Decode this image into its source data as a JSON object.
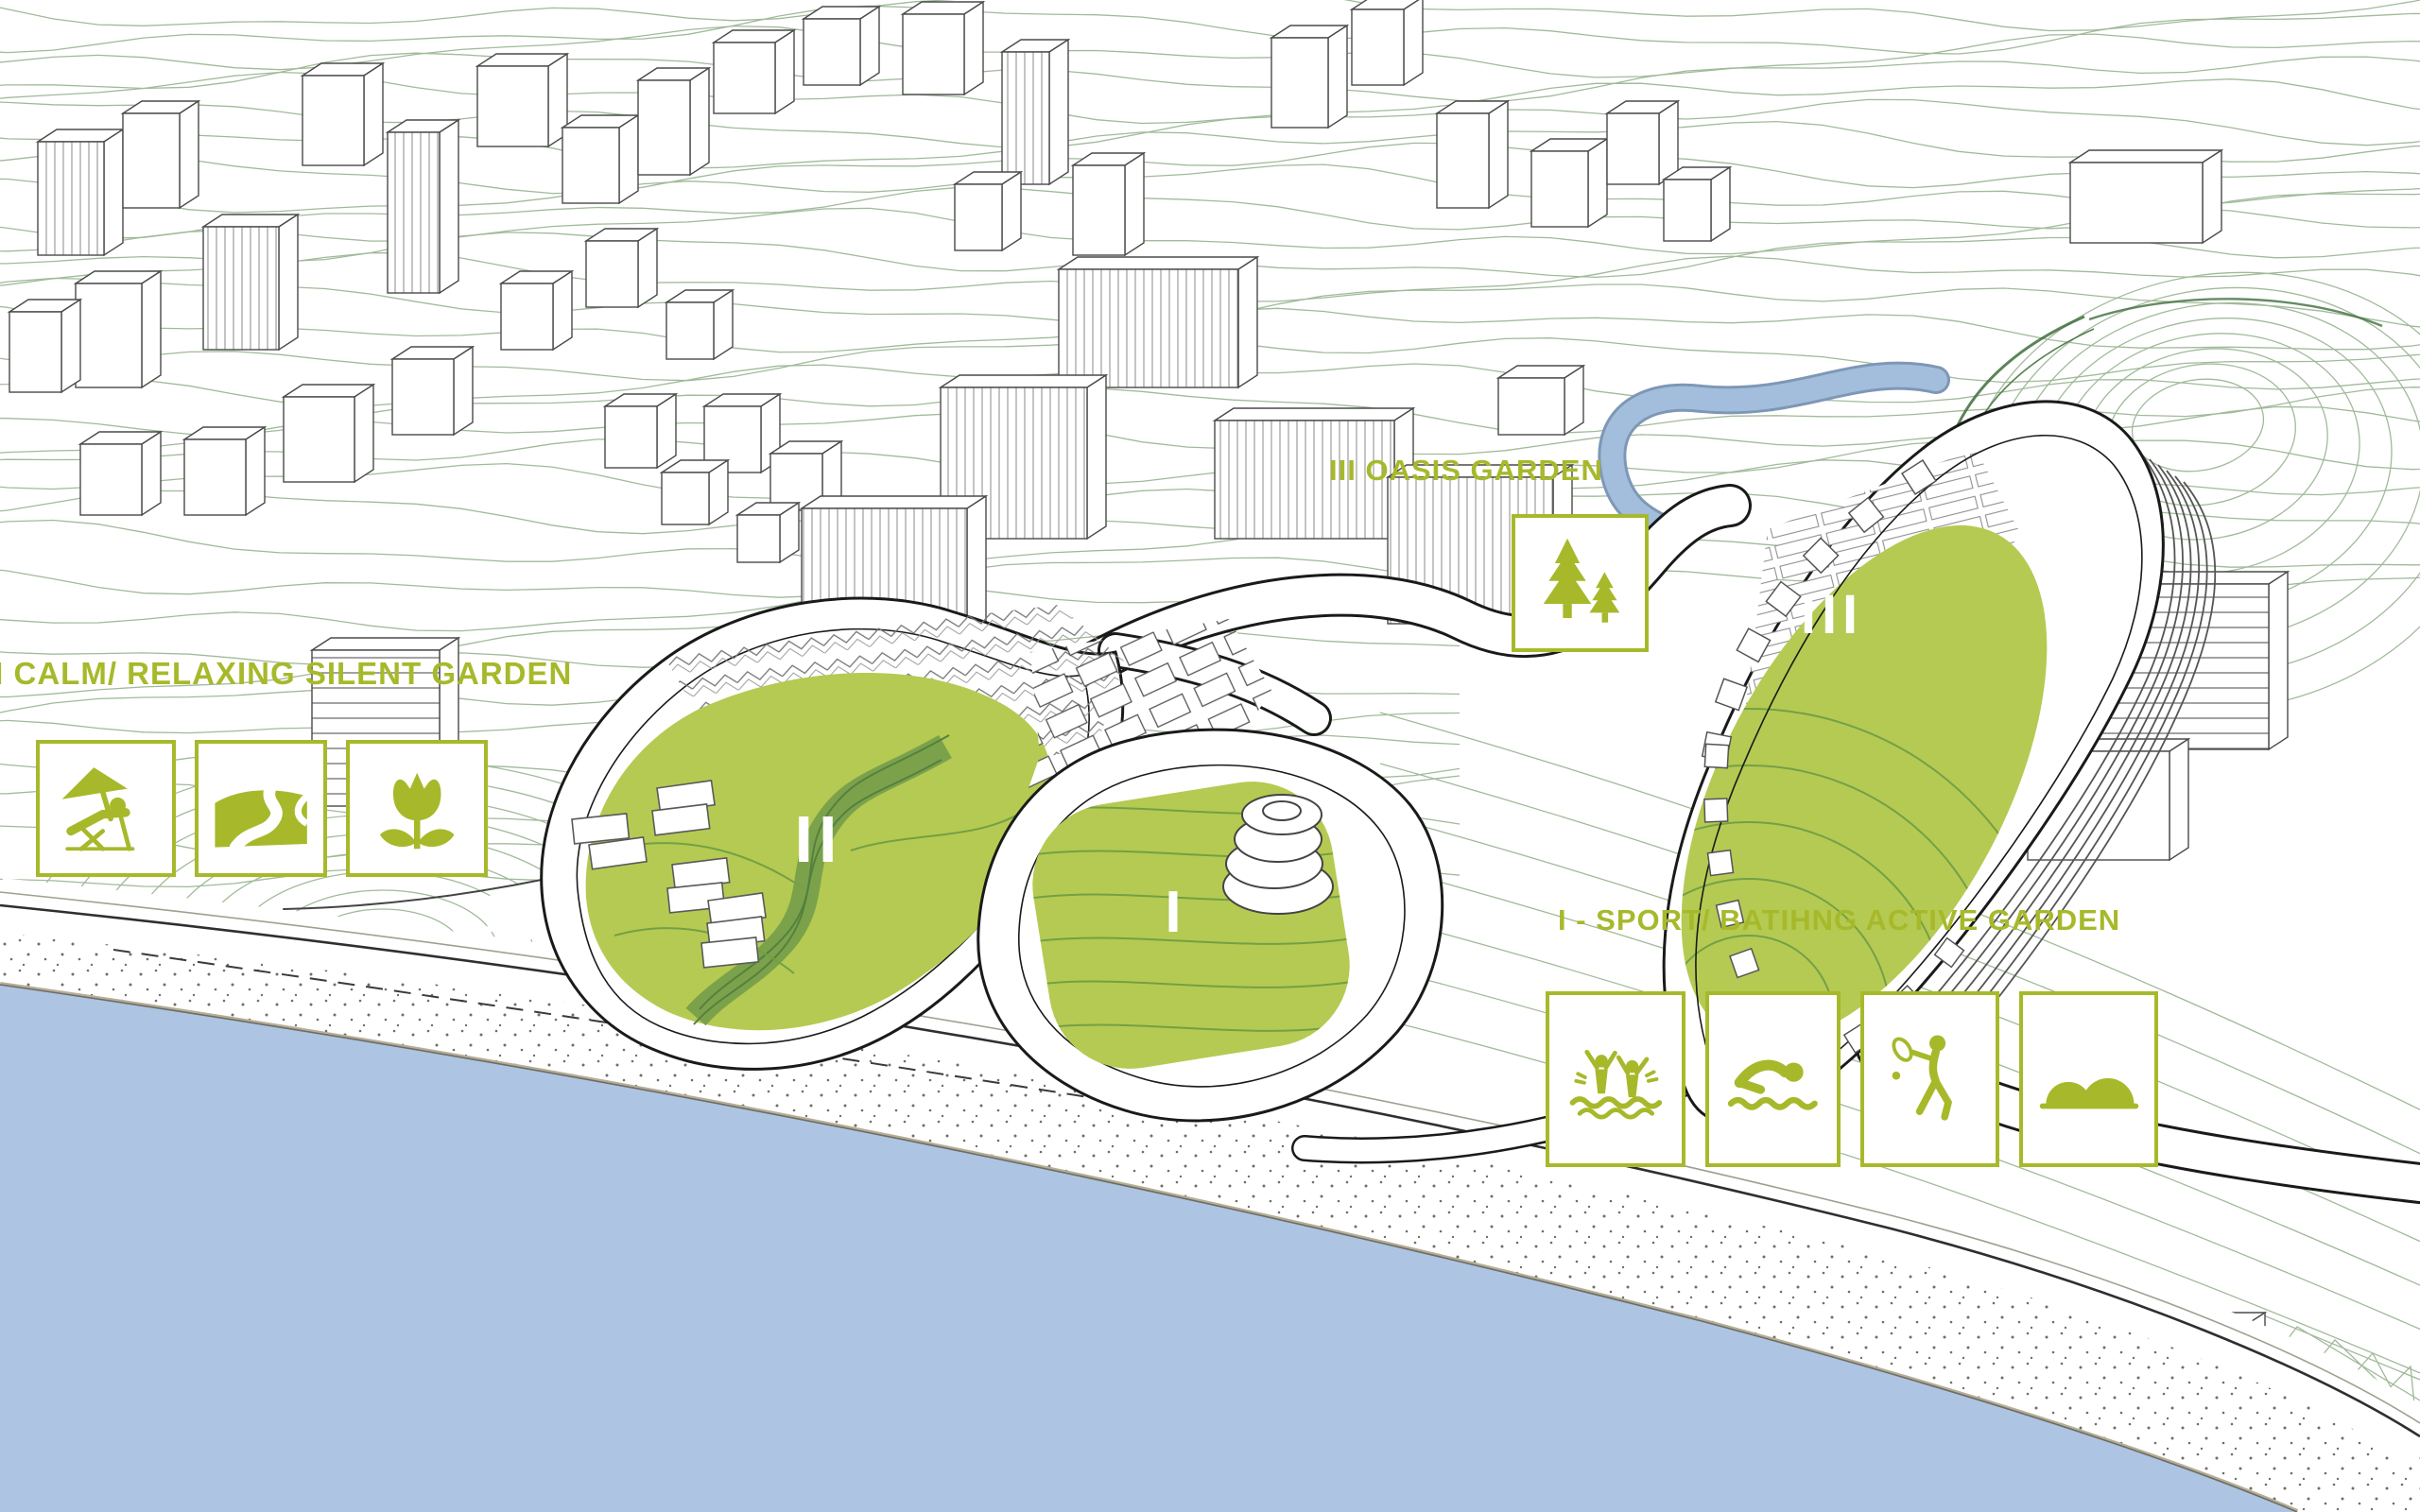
{
  "colors": {
    "accent_green": "#a7b92a",
    "garden_green": "#b5ca52",
    "band_green": "#7ba24b",
    "contour_green": "#9cb795",
    "ridge_green": "#3f6e3c",
    "sea_blue": "#adc4e2",
    "river_blue": "#a3bedd",
    "ink": "#2f2f2f"
  },
  "gardens": {
    "one": {
      "numeral": "I",
      "label": "I - SPORT/ BATIHNG ACTIVE GARDEN",
      "legend_icons": [
        "water-play-icon",
        "swimming-icon",
        "tennis-icon",
        "dunes-icon"
      ]
    },
    "two": {
      "numeral": "II",
      "label": "II CALM/ RELAXING SILENT GARDEN",
      "legend_icons": [
        "beach-lounger-icon",
        "winding-path-icon",
        "flower-icon"
      ]
    },
    "three": {
      "numeral": "III",
      "label": "III OASIS GARDEN",
      "legend_icons": [
        "trees-icon"
      ]
    }
  }
}
